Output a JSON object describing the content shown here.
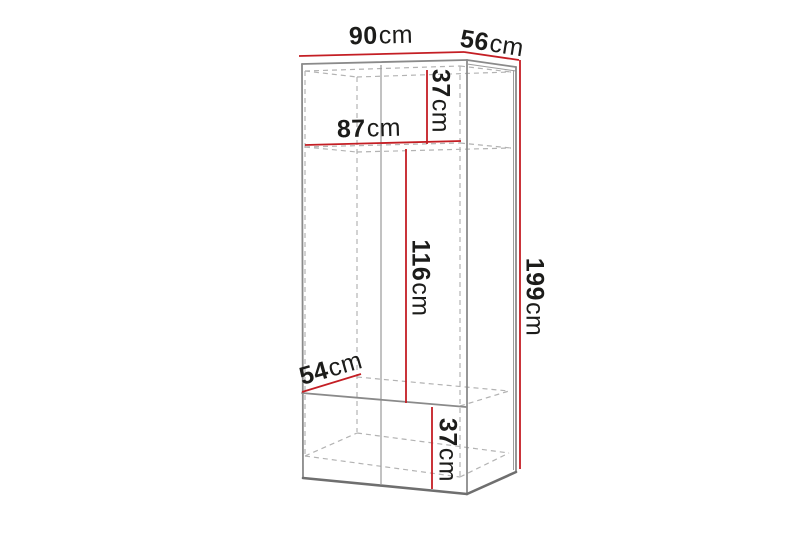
{
  "diagram": {
    "name": "Wardrobe dimension diagram",
    "unit": "cm",
    "colors": {
      "dimension_line": "#c41e24",
      "outline": "#8a8a8a",
      "hidden_line": "#b3b3b3",
      "label_text": "#1c1c1a",
      "background": "#ffffff"
    },
    "dimensions": [
      {
        "id": "overall-width",
        "value": "90",
        "unit": "cm"
      },
      {
        "id": "overall-depth",
        "value": "56",
        "unit": "cm"
      },
      {
        "id": "top-compartment-height",
        "value": "37",
        "unit": "cm"
      },
      {
        "id": "interior-width",
        "value": "87",
        "unit": "cm"
      },
      {
        "id": "hanging-space-height",
        "value": "116",
        "unit": "cm"
      },
      {
        "id": "overall-height",
        "value": "199",
        "unit": "cm"
      },
      {
        "id": "interior-depth",
        "value": "54",
        "unit": "cm"
      },
      {
        "id": "bottom-compartment-height",
        "value": "37",
        "unit": "cm"
      }
    ]
  }
}
